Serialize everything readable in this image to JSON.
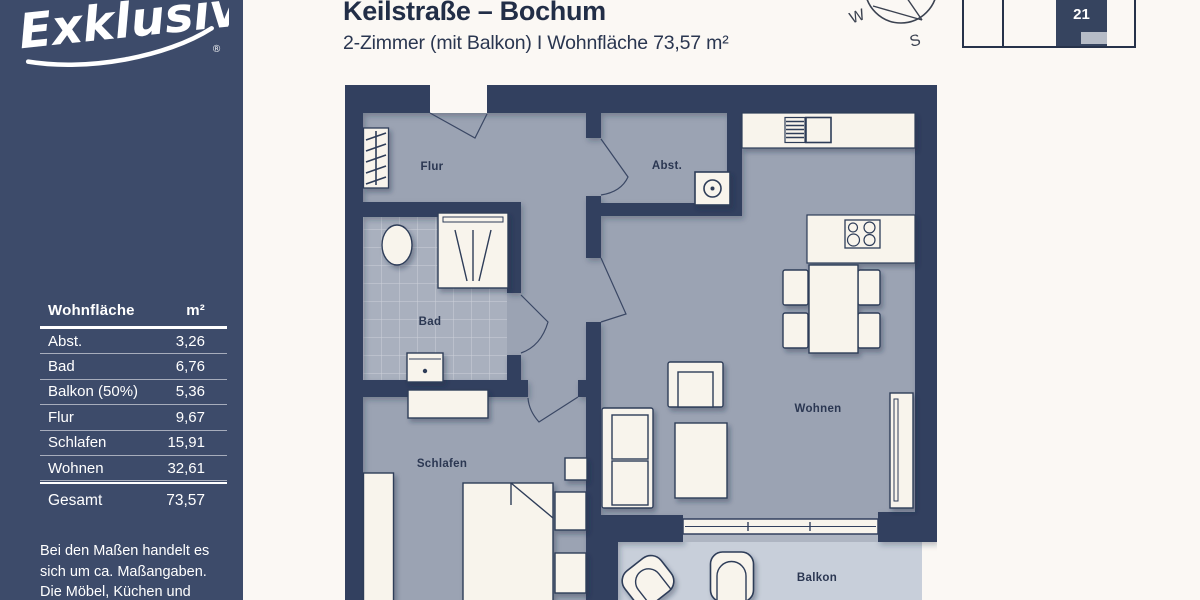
{
  "header": {
    "title": "Keilstraße – Bochum",
    "subtitle": "2-Zimmer (mit Balkon) I Wohnfläche 73,57 m²"
  },
  "compass": {
    "west": "W",
    "south": "S"
  },
  "locator": {
    "unit_number": "21"
  },
  "sidebar": {
    "logo_text": "Exklusiv",
    "logo_reg": "®",
    "table": {
      "header_label": "Wohnfläche",
      "header_unit": "m²",
      "rows": [
        {
          "label": "Abst.",
          "value": "3,26"
        },
        {
          "label": "Bad",
          "value": "6,76"
        },
        {
          "label": "Balkon (50%)",
          "value": "5,36"
        },
        {
          "label": "Flur",
          "value": "9,67"
        },
        {
          "label": "Schlafen",
          "value": "15,91"
        },
        {
          "label": "Wohnen",
          "value": "32,61"
        }
      ],
      "total": {
        "label": "Gesamt",
        "value": "73,57"
      }
    },
    "disclaimer": [
      "Bei den Maßen handelt es",
      "sich um ca. Maßangaben.",
      "Die Möbel, Küchen und",
      "Sanitärobjekte sind"
    ]
  },
  "plan": {
    "labels": {
      "flur": "Flur",
      "abst": "Abst.",
      "bad": "Bad",
      "schlafen": "Schlafen",
      "wohnen": "Wohnen",
      "balkon": "Balkon"
    }
  },
  "colors": {
    "sidebar": "#3d4b6a",
    "wall": "#32405e",
    "floor": "#9ba3b3",
    "tile": "#a9b0be",
    "balcony": "#c8cfda",
    "furniture": "#f8f4ec",
    "accent_text": "#232f4a",
    "locator_gray": "#b6bcc7"
  }
}
